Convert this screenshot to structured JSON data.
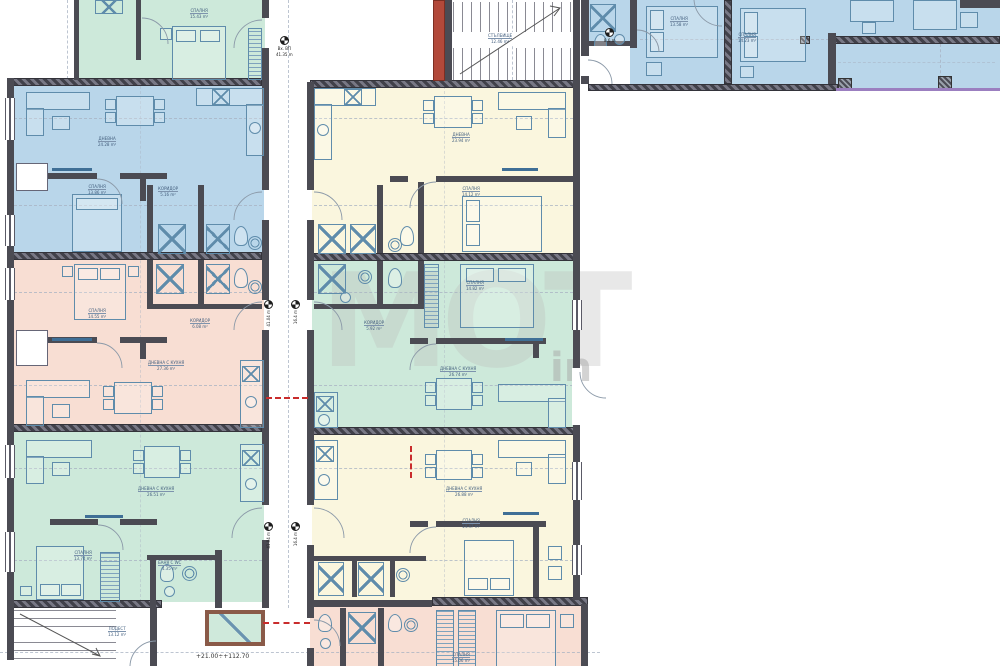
{
  "meta": {
    "drawing_type": "apartment-building-floor-plan"
  },
  "colors": {
    "unit_green": "#cde9da",
    "unit_blue": "#b9d6ea",
    "unit_yellow": "#faf6de",
    "unit_pink": "#f8ded3",
    "wall": "#4b4b53",
    "stair_core_red": "#b2493a",
    "elevator_brown": "#8a5a48",
    "terrace_edge_purple": "#9b7fc0",
    "furniture_line": "#5f8cab",
    "fire_line_red": "#c92c2c"
  },
  "units": [
    {
      "name": "apartment-top-left",
      "color": "green"
    },
    {
      "name": "apartment-left-row1",
      "color": "blue"
    },
    {
      "name": "apartment-left-row2",
      "color": "pink"
    },
    {
      "name": "apartment-left-row3",
      "color": "green"
    },
    {
      "name": "apartment-center-row1",
      "color": "yellow"
    },
    {
      "name": "apartment-center-row2",
      "color": "green"
    },
    {
      "name": "apartment-center-row3",
      "color": "yellow"
    },
    {
      "name": "apartment-bottom-center",
      "color": "pink"
    },
    {
      "name": "apartment-wing-top-right",
      "color": "blue"
    }
  ],
  "texts": {
    "elevation": "+21.00÷+112.70",
    "marker_top1": "Вх. ВП",
    "marker_top2": "41.35 m",
    "marker_a": "41.04 m",
    "marker_b": "16.4 m",
    "marker_wing": "8.6 m"
  },
  "watermark": {
    "main": "MOT",
    "sub": "in"
  },
  "room_labels": {
    "l1": {
      "n": "СПАЛНЯ",
      "a": "15.43 m²"
    },
    "l2": {
      "n": "ДНЕВНА",
      "a": "24.28 m²"
    },
    "l3": {
      "n": "СПАЛНЯ",
      "a": "13.86 m²"
    },
    "l4": {
      "n": "КОРИДОР",
      "a": "5.16 m²"
    },
    "l5": {
      "n": "ДНЕВНА",
      "a": "23.94 m²"
    },
    "l6": {
      "n": "СПАЛНЯ",
      "a": "14.12 m²"
    },
    "l7": {
      "n": "СПАЛНЯ",
      "a": "14.55 m²"
    },
    "l8": {
      "n": "КОРИДОР",
      "a": "6.08 m²"
    },
    "l9": {
      "n": "ДНЕВНА С КУХНЯ",
      "a": "27.36 m²"
    },
    "l10": {
      "n": "СПАЛНЯ",
      "a": "14.82 m²"
    },
    "l11": {
      "n": "КОРИДОР",
      "a": "5.92 m²"
    },
    "l12": {
      "n": "ДНЕВНА С КУХНЯ",
      "a": "26.74 m²"
    },
    "l13": {
      "n": "ДНЕВНА С КУХНЯ",
      "a": "26.51 m²"
    },
    "l14": {
      "n": "СПАЛНЯ",
      "a": "13.74 m²"
    },
    "l15": {
      "n": "БАНЯ С WC",
      "a": "4.35 m²"
    },
    "l16": {
      "n": "ДНЕВНА С КУХНЯ",
      "a": "26.88 m²"
    },
    "l17": {
      "n": "СПАЛНЯ",
      "a": "14.47 m²"
    },
    "l18": {
      "n": "СПАЛНЯ",
      "a": "15.06 m²"
    },
    "l19": {
      "n": "СПАЛНЯ",
      "a": "13.58 m²"
    },
    "l20": {
      "n": "СПАЛНЯ",
      "a": "14.23 m²"
    },
    "l21": {
      "n": "СТЪЛБИЩЕ",
      "a": "12.46 m²"
    },
    "l22": {
      "n": "ПОДЕСТ",
      "a": "13.12 m²"
    }
  }
}
